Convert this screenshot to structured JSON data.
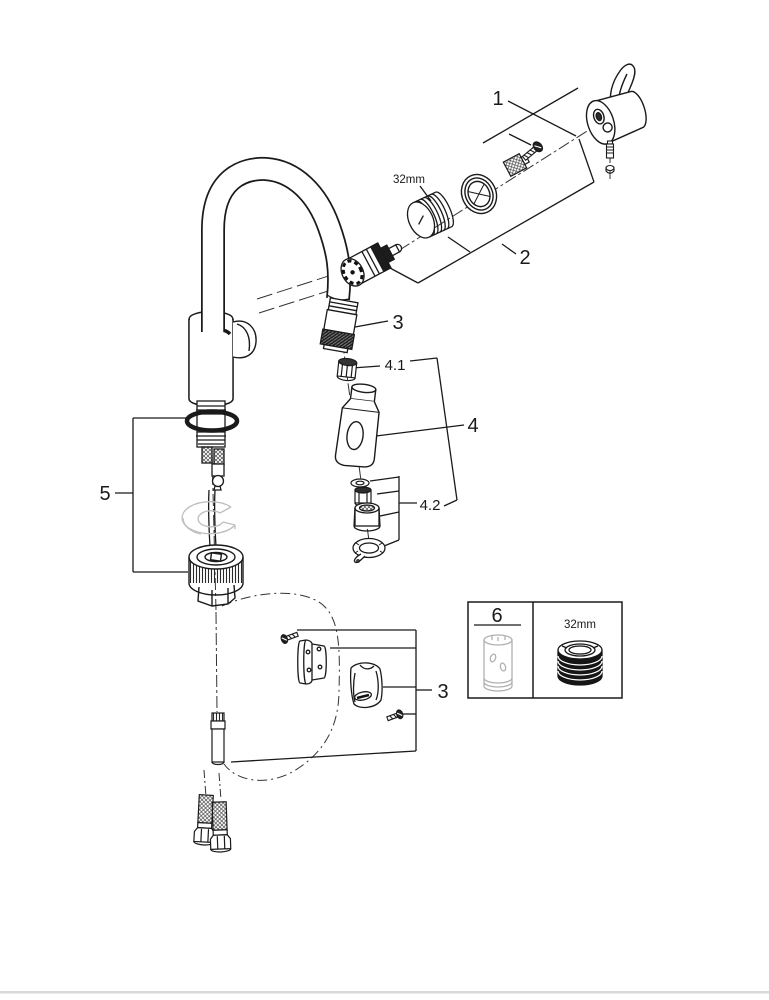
{
  "diagram": {
    "type": "exploded-parts-diagram",
    "subject": "pull-down kitchen faucet spare parts",
    "colors": {
      "line": "#1a1a1a",
      "gray_part": "#c0c0c0",
      "legend_gray": "#b0b0b0",
      "background": "#ffffff",
      "footer_rule": "#d9d9d9"
    }
  },
  "labels": {
    "part1": "1",
    "part2": "2",
    "part3_spout": "3",
    "part4_1": "4.1",
    "part4": "4",
    "part4_2": "4.2",
    "part5": "5",
    "part3_holder": "3",
    "part6": "6",
    "size_cartridge_nut": "32mm",
    "size_legend_nut": "32mm"
  }
}
